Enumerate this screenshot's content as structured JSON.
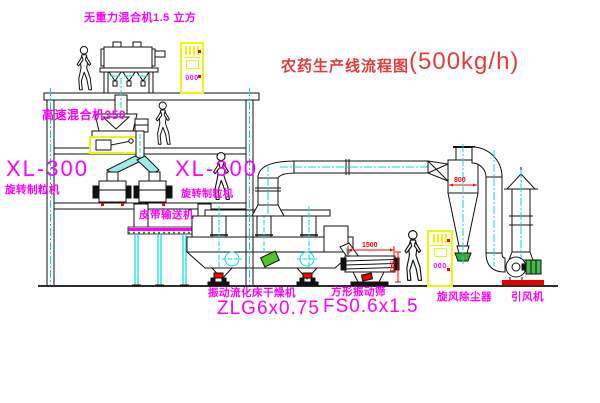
{
  "title": {
    "name": "农药生产线流程图",
    "capacity": "(500kg/h)"
  },
  "equipment": {
    "gravity_mixer": {
      "label": "无重力混合机1.5 立方"
    },
    "high_speed_mixer": {
      "label": "高速混合机350"
    },
    "granulator_left": {
      "model": "XL-300",
      "name": "旋转制粒机"
    },
    "granulator_right": {
      "model": "XL-300",
      "name": "旋转制粒机"
    },
    "belt_conveyor": {
      "label": "皮带输送机"
    },
    "fluid_bed_dryer": {
      "name": "振动流化床干燥机",
      "model": "ZLG6x0.75"
    },
    "vibrating_sieve": {
      "name": "方形振动筛",
      "model": "FS0.6x1.5"
    },
    "cyclone": {
      "label": "旋风除尘器"
    },
    "induced_draft_fan": {
      "label": "引风机"
    },
    "control_cabinet_top": {
      "display": "000"
    },
    "control_cabinet_right": {
      "display": "000"
    }
  },
  "dimensions": {
    "cyclone_diameter": "800",
    "sieve_length": "1500",
    "sieve_height": "541"
  },
  "colors": {
    "label_magenta": "#ff00ff",
    "title_red": "#e43c3c",
    "dimension_red": "#ff0000",
    "centerline_cyan": "#00dede",
    "cabinet_yellow": "#f2f20a",
    "motor_green": "#44bb44",
    "belt_magenta": "#ff00ff"
  }
}
